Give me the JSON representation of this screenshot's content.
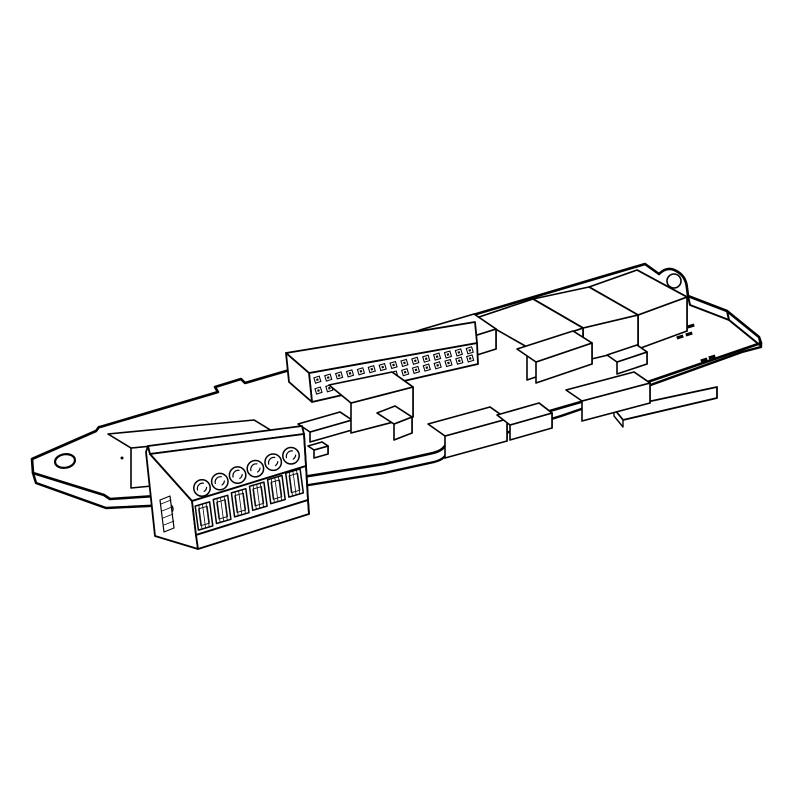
{
  "illustration": {
    "subject": "Isometric black line drawing of a PCB option card with a pluggable screw terminal block",
    "style": "technical line art",
    "background_color": "#ffffff",
    "line_color": "#000000"
  },
  "board": {
    "mounting_holes": 2,
    "back_edge_bumps": 2,
    "front_notch": 1,
    "edge_connector_present": true
  },
  "terminal_block": {
    "screw_count": 6,
    "wire_openings": 6,
    "side_screw_count": 1
  },
  "pin_header": {
    "rows": 2,
    "columns": 15
  },
  "components": {
    "relay_count": 3,
    "ic_box_count": 11,
    "smd_mark_cluster_sizes": [
      4,
      2
    ],
    "pin1_dot": 1
  }
}
